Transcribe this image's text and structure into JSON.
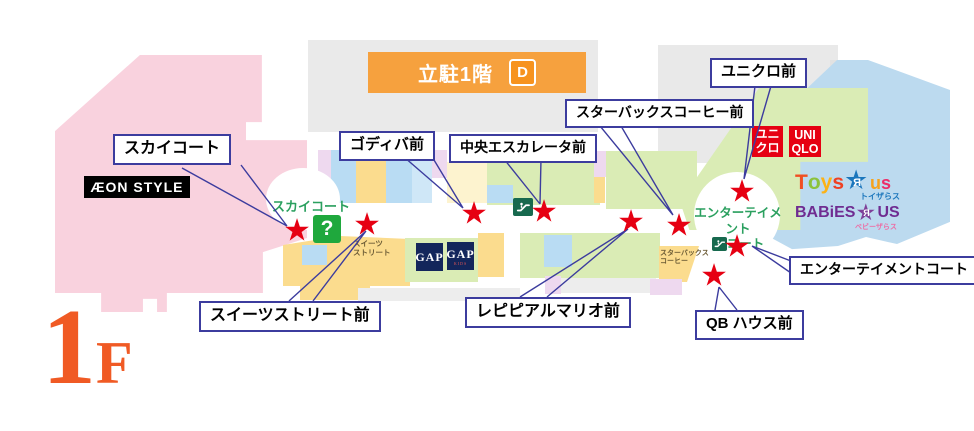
{
  "floor": {
    "number": "1",
    "suffix": "F"
  },
  "map": {
    "parking": {
      "label": "立駐1階",
      "zone": "D"
    },
    "aeon_style": "ÆON STYLE",
    "sky_court": "スカイコート",
    "info": "?",
    "sweets_street": {
      "line1": "スイーツ",
      "line2": "ストリート"
    },
    "starbucks": {
      "line1": "スターバックス",
      "line2": "コーヒー"
    },
    "entertainment_court": {
      "line1": "エンターテイメント",
      "line2": "コート"
    },
    "gap": {
      "label": "GAP"
    },
    "gap_kids": {
      "label": "GAP",
      "sub": "KIDS"
    },
    "uniqlo_jp": {
      "line1": "ユニ",
      "line2": "クロ"
    },
    "uniqlo_en": {
      "line1": "UNI",
      "line2": "QLO"
    },
    "toysrus": {
      "l1": "T",
      "l2": "o",
      "l3": "y",
      "l4": "s",
      "r": "Я",
      "l5": "u",
      "l6": "s",
      "jp": "トイザらス"
    },
    "babiesrus": {
      "left": "BABiES",
      "r": "Я",
      "right": "US",
      "jp": "ベビーザらス"
    },
    "star_glyph": "★"
  },
  "callouts": [
    {
      "id": "sky-court",
      "label": "スカイコート"
    },
    {
      "id": "godiva",
      "label": "ゴディバ前"
    },
    {
      "id": "central-escalator",
      "label": "中央エスカレータ前"
    },
    {
      "id": "starbucks",
      "label": "スターバックスコーヒー前"
    },
    {
      "id": "uniqlo",
      "label": "ユニクロ前"
    },
    {
      "id": "entertainment-court",
      "label": "エンターテイメントコート"
    },
    {
      "id": "qb-house",
      "label": "QB ハウス前"
    },
    {
      "id": "repipi-armario",
      "label": "レピピアルマリオ前"
    },
    {
      "id": "sweets-street",
      "label": "スイーツストリート前"
    }
  ],
  "colors": {
    "star_red": "#e60012",
    "callout_border": "#3c3c9e",
    "uniqlo_red": "#e60012",
    "gap_navy": "#13265b",
    "parking_banner_orange": "#f6a13e",
    "parking_zone_badge_orange": "#f7931e",
    "floor_label_orange": "#f05a24",
    "court_text_green": "#2ba05f",
    "info_icon_green": "#1fa83d",
    "escalator_icon_green": "#17694e",
    "aeon_area_pink": "#f9d2de",
    "toysrus_area_blue": "#bcdaef",
    "uniqlo_area_green": "#daecb5"
  }
}
